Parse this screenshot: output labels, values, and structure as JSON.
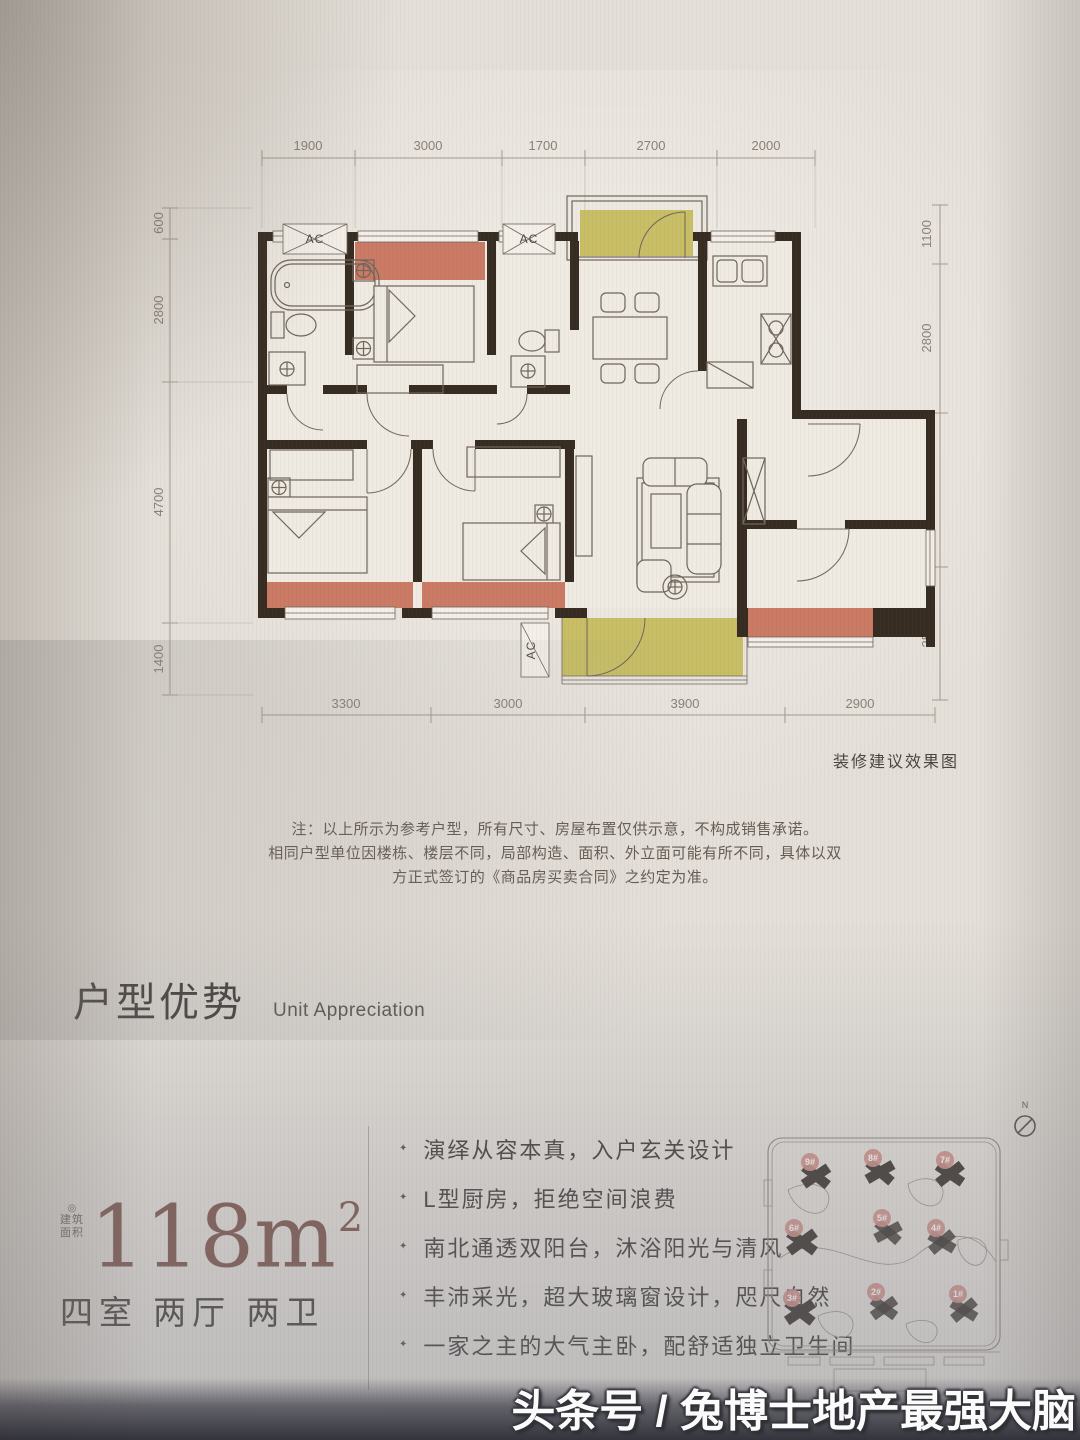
{
  "floor_plan": {
    "dims_top": [
      "1900",
      "3000",
      "1700",
      "2700",
      "2000"
    ],
    "dims_left": [
      "600",
      "2800",
      "4700",
      "1400"
    ],
    "dims_right": [
      "1100",
      "2800",
      "2900",
      "2500"
    ],
    "dims_bottom": [
      "3300",
      "3000",
      "3900",
      "2900"
    ],
    "ac_label": "AC",
    "render_caption": "装修建议效果图"
  },
  "notes": {
    "line1": "注：以上所示为参考户型，所有尺寸、房屋布置仅供示意，不构成销售承诺。",
    "line2": "相同户型单位因楼栋、楼层不同，局部构造、面积、外立面可能有所不同，具体以双方正式签订的《商品房买卖合同》之约定为准。"
  },
  "section_header": {
    "title_cn": "户型优势",
    "title_en": "Unit Appreciation"
  },
  "unit_info": {
    "reg_mark": "◎",
    "area_prefix_line1": "建筑",
    "area_prefix_line2": "面积",
    "area_value": "118m",
    "area_exponent": "2",
    "rooms": "四室 两厅 两卫"
  },
  "features": [
    "演绎从容本真，入户玄关设计",
    "L型厨房，拒绝空间浪费",
    "南北通透双阳台，沐浴阳光与清风",
    "丰沛采光，超大玻璃窗设计，咫尺自然",
    "一家之主的大气主卧，配舒适独立卫生间"
  ],
  "icons": {
    "bullet": "✦"
  },
  "site_plan": {
    "north_label": "N",
    "buildings": [
      "9#",
      "8#",
      "7#",
      "6#",
      "5#",
      "4#",
      "3#",
      "2#",
      "1#"
    ]
  },
  "watermark": "头条号 / 兔博士地产最强大脑",
  "colors": {
    "accent_red": "#c7705a",
    "accent_yellow": "#c6bc5f",
    "wall": "#362c22",
    "area_text": "#7d544a"
  }
}
